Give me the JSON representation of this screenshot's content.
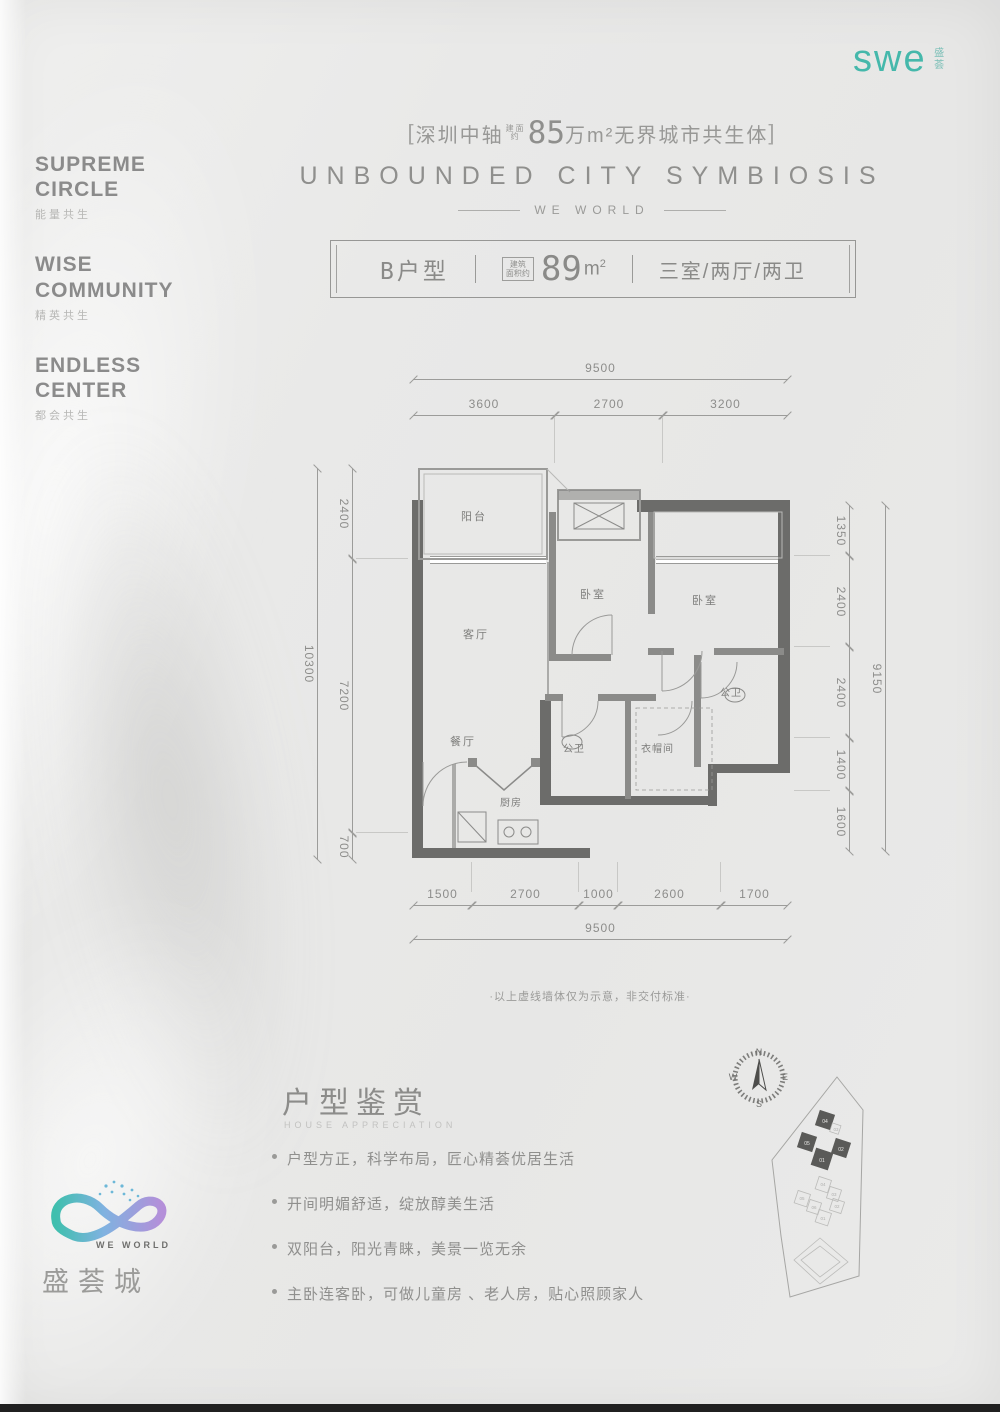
{
  "brand": {
    "logo": "swe",
    "logo_cn": "盛荟",
    "accent": "#45b8ab"
  },
  "sidebar": {
    "items": [
      {
        "en": "SUPREME CIRCLE",
        "cn": "能量共生"
      },
      {
        "en": "WISE COMMUNITY",
        "cn": "精英共生"
      },
      {
        "en": "ENDLESS CENTER",
        "cn": "都会共生"
      }
    ]
  },
  "header": {
    "bracket_l": "[",
    "city": "深圳中轴",
    "small_1": "建面",
    "small_2": "约",
    "big_number": "85",
    "suffix": "万m²无界城市共生体",
    "bracket_r": "]",
    "title_en": "UNBOUNDED CITY SYMBIOSIS",
    "sub": "WE WORLD"
  },
  "unit_bar": {
    "name_letter": "B",
    "name_rest": "户型",
    "area_tag_1": "建筑",
    "area_tag_2": "面积约",
    "area_num": "89",
    "area_unit": "m",
    "area_sup": "2",
    "rooms": "三室/两厅/两卫"
  },
  "plan": {
    "rooms": {
      "balcony": "阳台",
      "living": "客厅",
      "dining": "餐厅",
      "kitchen": "厨房",
      "bedroom_a": "卧室",
      "bedroom_b": "卧室",
      "bath_a": "公卫",
      "bath_b": "公卫",
      "closet": "衣帽间"
    },
    "dims": {
      "top": {
        "overall": "9500",
        "segs": [
          "3600",
          "2700",
          "3200"
        ]
      },
      "bottom": {
        "overall": "9500",
        "segs": [
          "1500",
          "2700",
          "1000",
          "2600",
          "1700"
        ]
      },
      "left": {
        "overall": "10300",
        "segs": [
          "2400",
          "7200",
          "700"
        ]
      },
      "right": {
        "overall": "9150",
        "segs": [
          "1350",
          "2400",
          "2400",
          "1400",
          "1600"
        ]
      }
    },
    "note": "·以上虚线墙体仅为示意，非交付标准·"
  },
  "appreciation": {
    "cn": "户型鉴赏",
    "en": "HOUSE APPRECIATION",
    "bullets": [
      "户型方正，科学布局，匠心精荟优居生活",
      "开间明媚舒适，绽放醇美生活",
      "双阳台，阳光青睐，美景一览无余",
      "主卧连客卧，可做儿童房 、老人房，贴心照顾家人"
    ]
  },
  "footer_logo": {
    "en": "WE WORLD",
    "cn": "盛荟城"
  },
  "site": {
    "compass": {
      "n": "N",
      "e": "E",
      "s": "S",
      "w": "W"
    },
    "dark_buildings": [
      "04",
      "05",
      "02",
      "01"
    ],
    "light_buildings": [
      "03",
      "04",
      "03",
      "05",
      "06",
      "02",
      "01"
    ]
  }
}
